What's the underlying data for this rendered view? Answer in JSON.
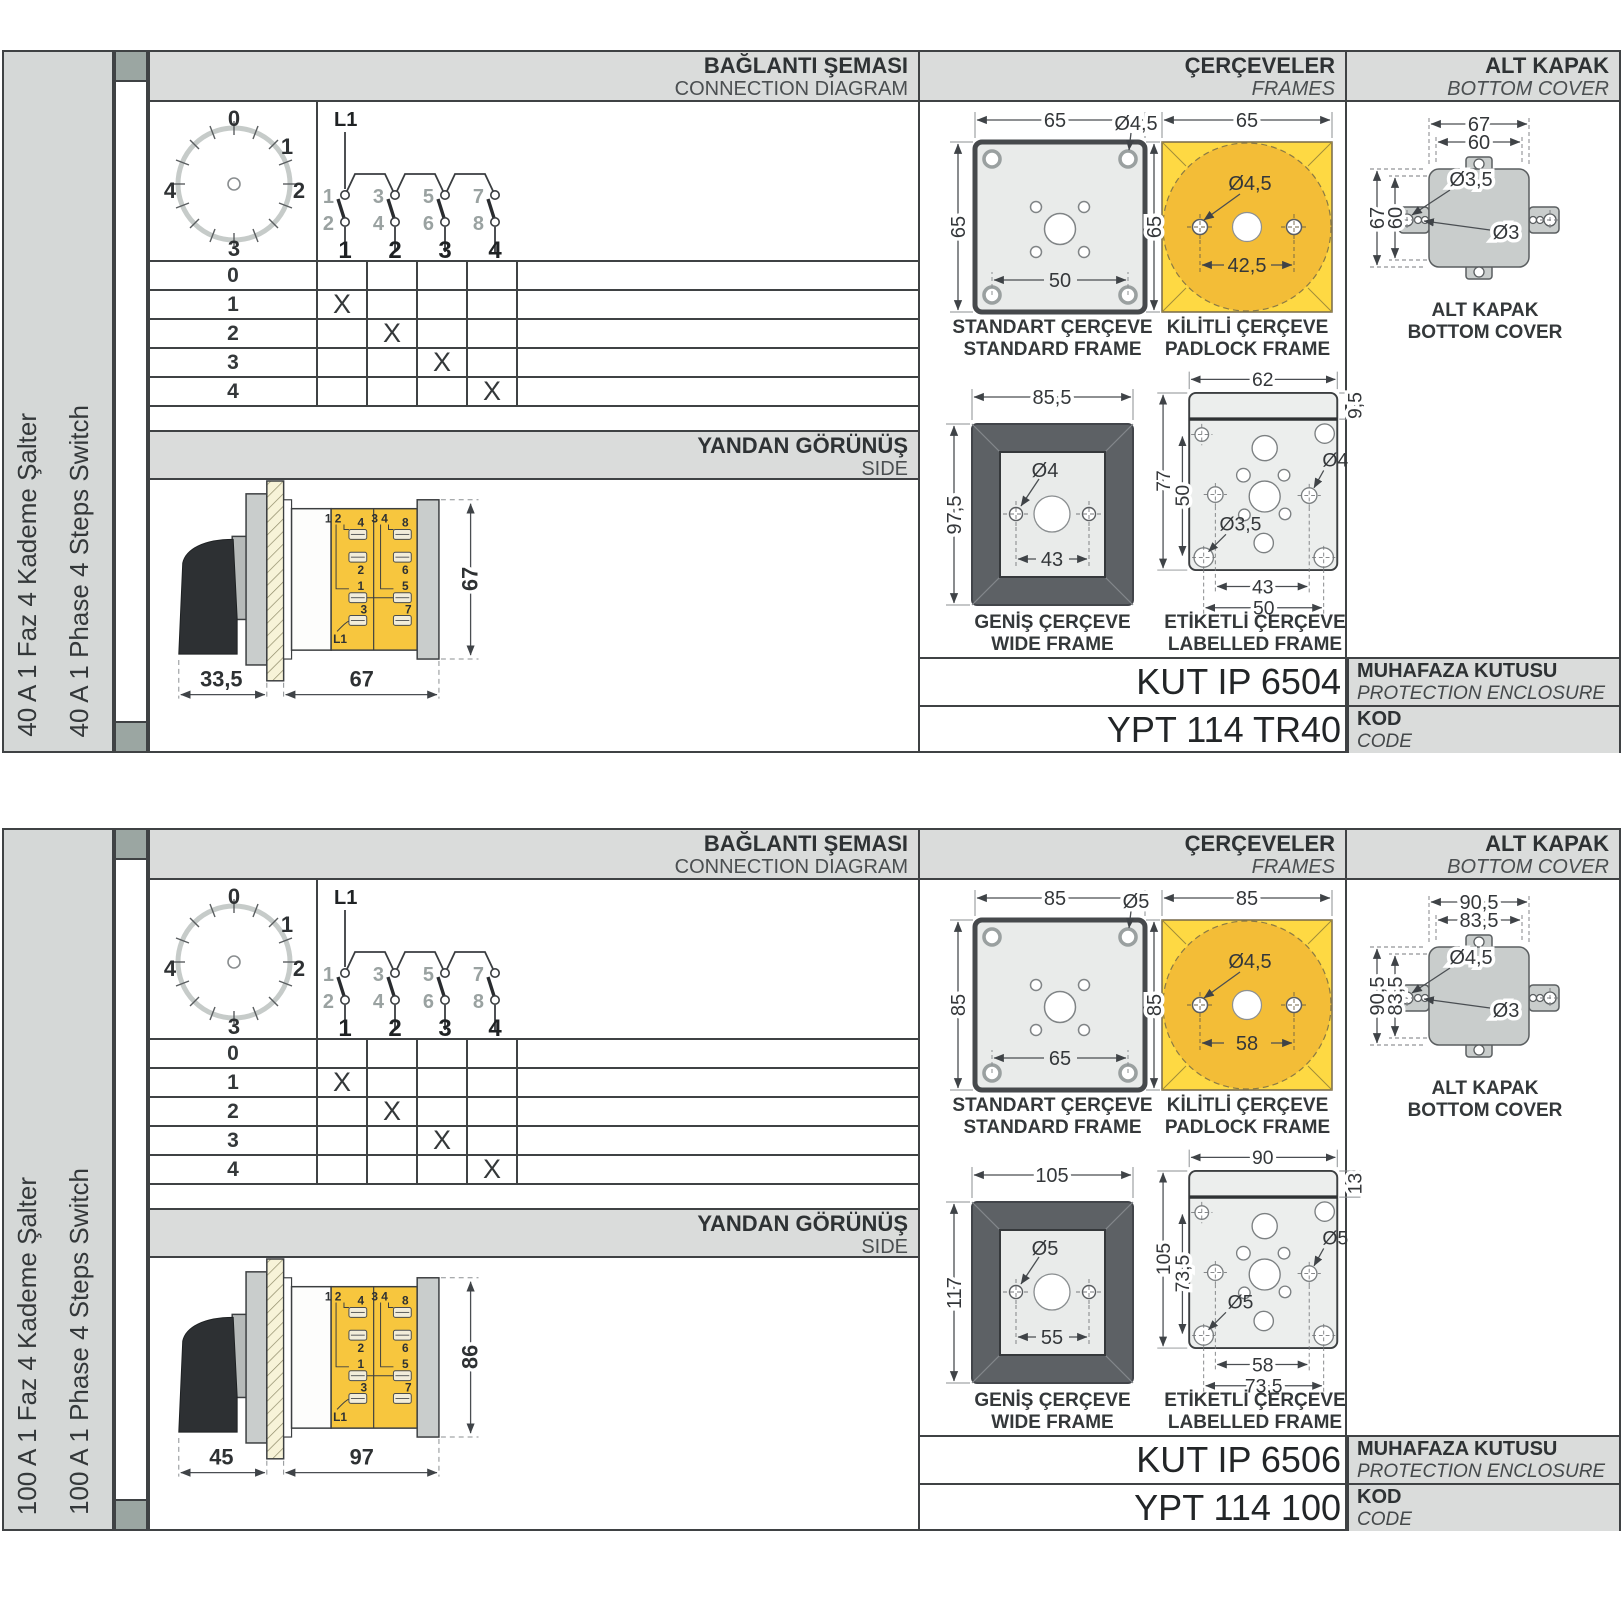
{
  "sections": [
    {
      "sidebar": {
        "tr": "40 A 1 Faz 4 Kademe Şalter",
        "en": "40 A 1 Phase 4 Steps Switch"
      },
      "headers": {
        "connection_tr": "BAĞLANTI ŞEMASI",
        "connection_en": "CONNECTION DIAGRAM",
        "frames_tr": "ÇERÇEVELER",
        "frames_en": "FRAMES",
        "cover_tr": "ALT KAPAK",
        "cover_en": "BOTTOM COVER",
        "side_tr": "YANDAN GÖRÜNÜŞ",
        "side_en": "SIDE"
      },
      "dial": {
        "p0": "0",
        "p1": "1",
        "p2": "2",
        "p3": "3",
        "p4": "4"
      },
      "schematic": {
        "supply": "L1",
        "top": [
          "1",
          "3",
          "5",
          "7"
        ],
        "bottom": [
          "2",
          "4",
          "6",
          "8"
        ],
        "terminals": [
          "1",
          "2",
          "3",
          "4"
        ]
      },
      "table": {
        "rows": [
          {
            "label": "0",
            "marks": [
              "",
              "",
              "",
              ""
            ]
          },
          {
            "label": "1",
            "marks": [
              "X",
              "",
              "",
              ""
            ]
          },
          {
            "label": "2",
            "marks": [
              "",
              "X",
              "",
              ""
            ]
          },
          {
            "label": "3",
            "marks": [
              "",
              "",
              "X",
              ""
            ]
          },
          {
            "label": "4",
            "marks": [
              "",
              "",
              "",
              "X"
            ]
          }
        ]
      },
      "side_view": {
        "front": "33,5",
        "body": "67",
        "height": "67",
        "pair_left": "1 2",
        "pair_right": "3 4",
        "l1": "L1",
        "t4": "4",
        "t2": "2",
        "t1": "1",
        "t3": "3",
        "t8": "8",
        "t6": "6",
        "t5": "5",
        "t7": "7"
      },
      "frames": {
        "standard": {
          "tr": "STANDART ÇERÇEVE",
          "en": "STANDARD FRAME",
          "w": "65",
          "h": "65",
          "hole": "Ø4,5",
          "inner": "50"
        },
        "padlock": {
          "tr": "KİLİTLİ ÇERÇEVE",
          "en": "PADLOCK FRAME",
          "w": "65",
          "h": "65",
          "hole": "Ø4,5",
          "inner": "42,5"
        },
        "wide": {
          "tr": "GENİŞ ÇERÇEVE",
          "en": "WIDE FRAME",
          "w": "85,5",
          "h": "97,5",
          "hole": "Ø4",
          "inner": "43"
        },
        "labelled": {
          "tr": "ETİKETLİ ÇERÇEVE",
          "en": "LABELLED FRAME",
          "w": "62",
          "strip": "9,5",
          "h_outer": "77",
          "h_inner": "50",
          "hole_right": "Ø4",
          "hole_left": "Ø3,5",
          "b_inner": "43",
          "b_outer": "50"
        }
      },
      "cover": {
        "tr": "ALT KAPAK",
        "en": "BOTTOM COVER",
        "w1": "67",
        "w2": "60",
        "h1": "67",
        "h2": "60",
        "hole1": "Ø3,5",
        "hole2": "Ø3"
      },
      "codes": {
        "enclosure": "KUT IP 6504",
        "enclosure_tr": "MUHAFAZA KUTUSU",
        "enclosure_en": "PROTECTION ENCLOSURE",
        "code": "YPT 114 TR40",
        "code_tr": "KOD",
        "code_en": "CODE"
      }
    },
    {
      "sidebar": {
        "tr": "100 A 1 Faz 4 Kademe Şalter",
        "en": "100 A 1 Phase 4 Steps Switch"
      },
      "headers": {
        "connection_tr": "BAĞLANTI ŞEMASI",
        "connection_en": "CONNECTION DIAGRAM",
        "frames_tr": "ÇERÇEVELER",
        "frames_en": "FRAMES",
        "cover_tr": "ALT KAPAK",
        "cover_en": "BOTTOM COVER",
        "side_tr": "YANDAN GÖRÜNÜŞ",
        "side_en": "SIDE"
      },
      "dial": {
        "p0": "0",
        "p1": "1",
        "p2": "2",
        "p3": "3",
        "p4": "4"
      },
      "schematic": {
        "supply": "L1",
        "top": [
          "1",
          "3",
          "5",
          "7"
        ],
        "bottom": [
          "2",
          "4",
          "6",
          "8"
        ],
        "terminals": [
          "1",
          "2",
          "3",
          "4"
        ]
      },
      "table": {
        "rows": [
          {
            "label": "0",
            "marks": [
              "",
              "",
              "",
              ""
            ]
          },
          {
            "label": "1",
            "marks": [
              "X",
              "",
              "",
              ""
            ]
          },
          {
            "label": "2",
            "marks": [
              "",
              "X",
              "",
              ""
            ]
          },
          {
            "label": "3",
            "marks": [
              "",
              "",
              "X",
              ""
            ]
          },
          {
            "label": "4",
            "marks": [
              "",
              "",
              "",
              "X"
            ]
          }
        ]
      },
      "side_view": {
        "front": "45",
        "body": "97",
        "height": "86",
        "pair_left": "1 2",
        "pair_right": "3 4",
        "l1": "L1",
        "t4": "4",
        "t2": "2",
        "t1": "1",
        "t3": "3",
        "t8": "8",
        "t6": "6",
        "t5": "5",
        "t7": "7"
      },
      "frames": {
        "standard": {
          "tr": "STANDART ÇERÇEVE",
          "en": "STANDARD FRAME",
          "w": "85",
          "h": "85",
          "hole": "Ø5",
          "inner": "65"
        },
        "padlock": {
          "tr": "KİLİTLİ ÇERÇEVE",
          "en": "PADLOCK FRAME",
          "w": "85",
          "h": "85",
          "hole": "Ø4,5",
          "inner": "58"
        },
        "wide": {
          "tr": "GENİŞ ÇERÇEVE",
          "en": "WIDE FRAME",
          "w": "105",
          "h": "117",
          "hole": "Ø5",
          "inner": "55"
        },
        "labelled": {
          "tr": "ETİKETLİ ÇERÇEVE",
          "en": "LABELLED FRAME",
          "w": "90",
          "strip": "13",
          "h_outer": "105",
          "h_inner": "73,5",
          "hole_right": "Ø5",
          "hole_left": "Ø5",
          "b_inner": "58",
          "b_outer": "73,5"
        }
      },
      "cover": {
        "tr": "ALT KAPAK",
        "en": "BOTTOM COVER",
        "w1": "90,5",
        "w2": "83,5",
        "h1": "90,5",
        "h2": "83,5",
        "hole1": "Ø4,5",
        "hole2": "Ø3"
      },
      "codes": {
        "enclosure": "KUT IP 6506",
        "enclosure_tr": "MUHAFAZA KUTUSU",
        "enclosure_en": "PROTECTION ENCLOSURE",
        "code": "YPT 114 100",
        "code_tr": "KOD",
        "code_en": "CODE"
      }
    }
  ]
}
